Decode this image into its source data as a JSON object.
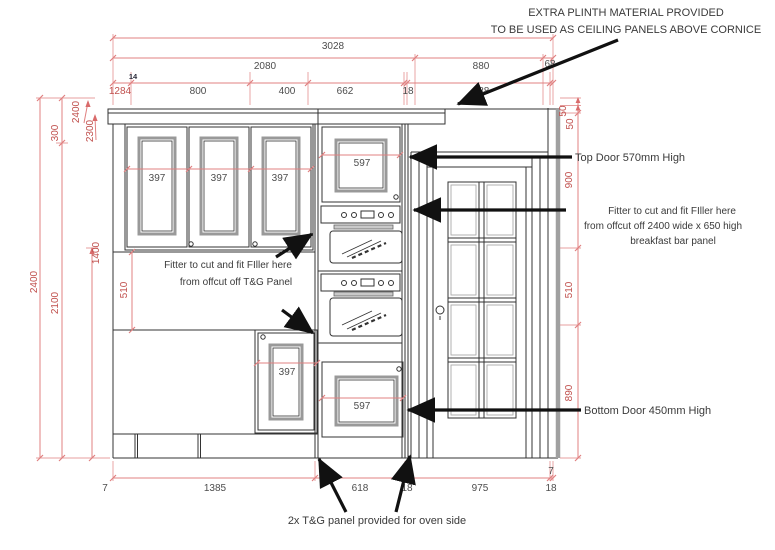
{
  "drawing_type": "kitchen elevation technical drawing",
  "colors": {
    "dimension_line": "#e08080",
    "dimension_text_red": "#c0504d",
    "dimension_text_dark": "#4d4d4d",
    "geometry_line": "#333333",
    "panel_bevel_gray": "#999999",
    "annotation_text": "#3a3a3a",
    "background": "#ffffff"
  },
  "dims": {
    "top1": "3028",
    "top2a": "2080",
    "top2b": "880",
    "top2c": "68",
    "t3a": "1284",
    "t3tiny": "14",
    "t3b": "800",
    "t3c": "400",
    "t3d": "662",
    "t3e": "18",
    "t3f": "988",
    "lv2400": "2400",
    "lv300": "300",
    "lv2100": "2100",
    "ld2400": "2400",
    "ld2300": "2300",
    "lv1400": "1400",
    "lv510": "510",
    "r50a": "50",
    "r50b": "50",
    "r900": "900",
    "r510": "510",
    "r890": "890",
    "b7a": "7",
    "b1385": "1385",
    "b618": "618",
    "b18a": "18",
    "b975": "975",
    "b18b": "18",
    "b7b": "7",
    "w397a": "397",
    "w397b": "397",
    "w397c": "397",
    "t597": "597",
    "bot597": "597",
    "base397": "397"
  },
  "notes": {
    "plinth1": "EXTRA PLINTH MATERIAL PROVIDED",
    "plinth2": "TO BE USED AS CEILING PANELS ABOVE CORNICE",
    "top_door": "Top Door 570mm High",
    "fill_r1": "Fitter to cut and fit FIller here",
    "fill_r2": "from offcut off 2400 wide x 650 high",
    "fill_r3": "breakfast bar panel",
    "fill_l1": "Fitter to cut and fit FIller here",
    "fill_l2": "from offcut off  T&G Panel",
    "bottom_door": "Bottom Door 450mm High",
    "tg": "2x T&G panel provided for oven side"
  }
}
